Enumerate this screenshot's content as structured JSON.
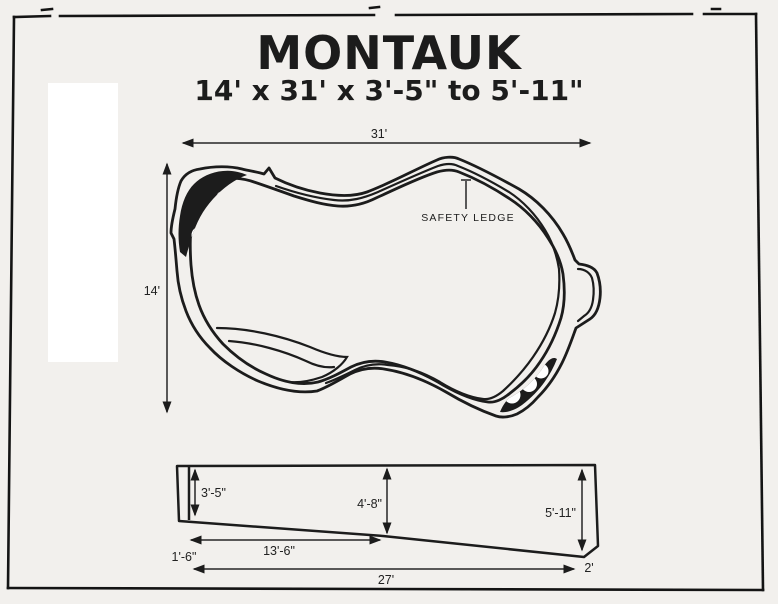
{
  "colors": {
    "ink": "#1c1c1c",
    "paper": "#f2f0ed",
    "patch_white": "#ffffff"
  },
  "title": {
    "main": "MONTAUK",
    "dimensions": "14' x 31' x 3'-5\" to 5'-11\""
  },
  "plan_view": {
    "length": "31'",
    "width": "14'",
    "safety_ledge": "SAFETY LEDGE"
  },
  "profile_view": {
    "shallow_depth": "3'-5\"",
    "middle_depth": "4'-8\"",
    "deep_depth": "5'-11\"",
    "shallow_slope_run": "13'-6\"",
    "shallow_entry": "1'-6\"",
    "overall_bottom": "27'",
    "deep_end_bevel": "2'"
  }
}
